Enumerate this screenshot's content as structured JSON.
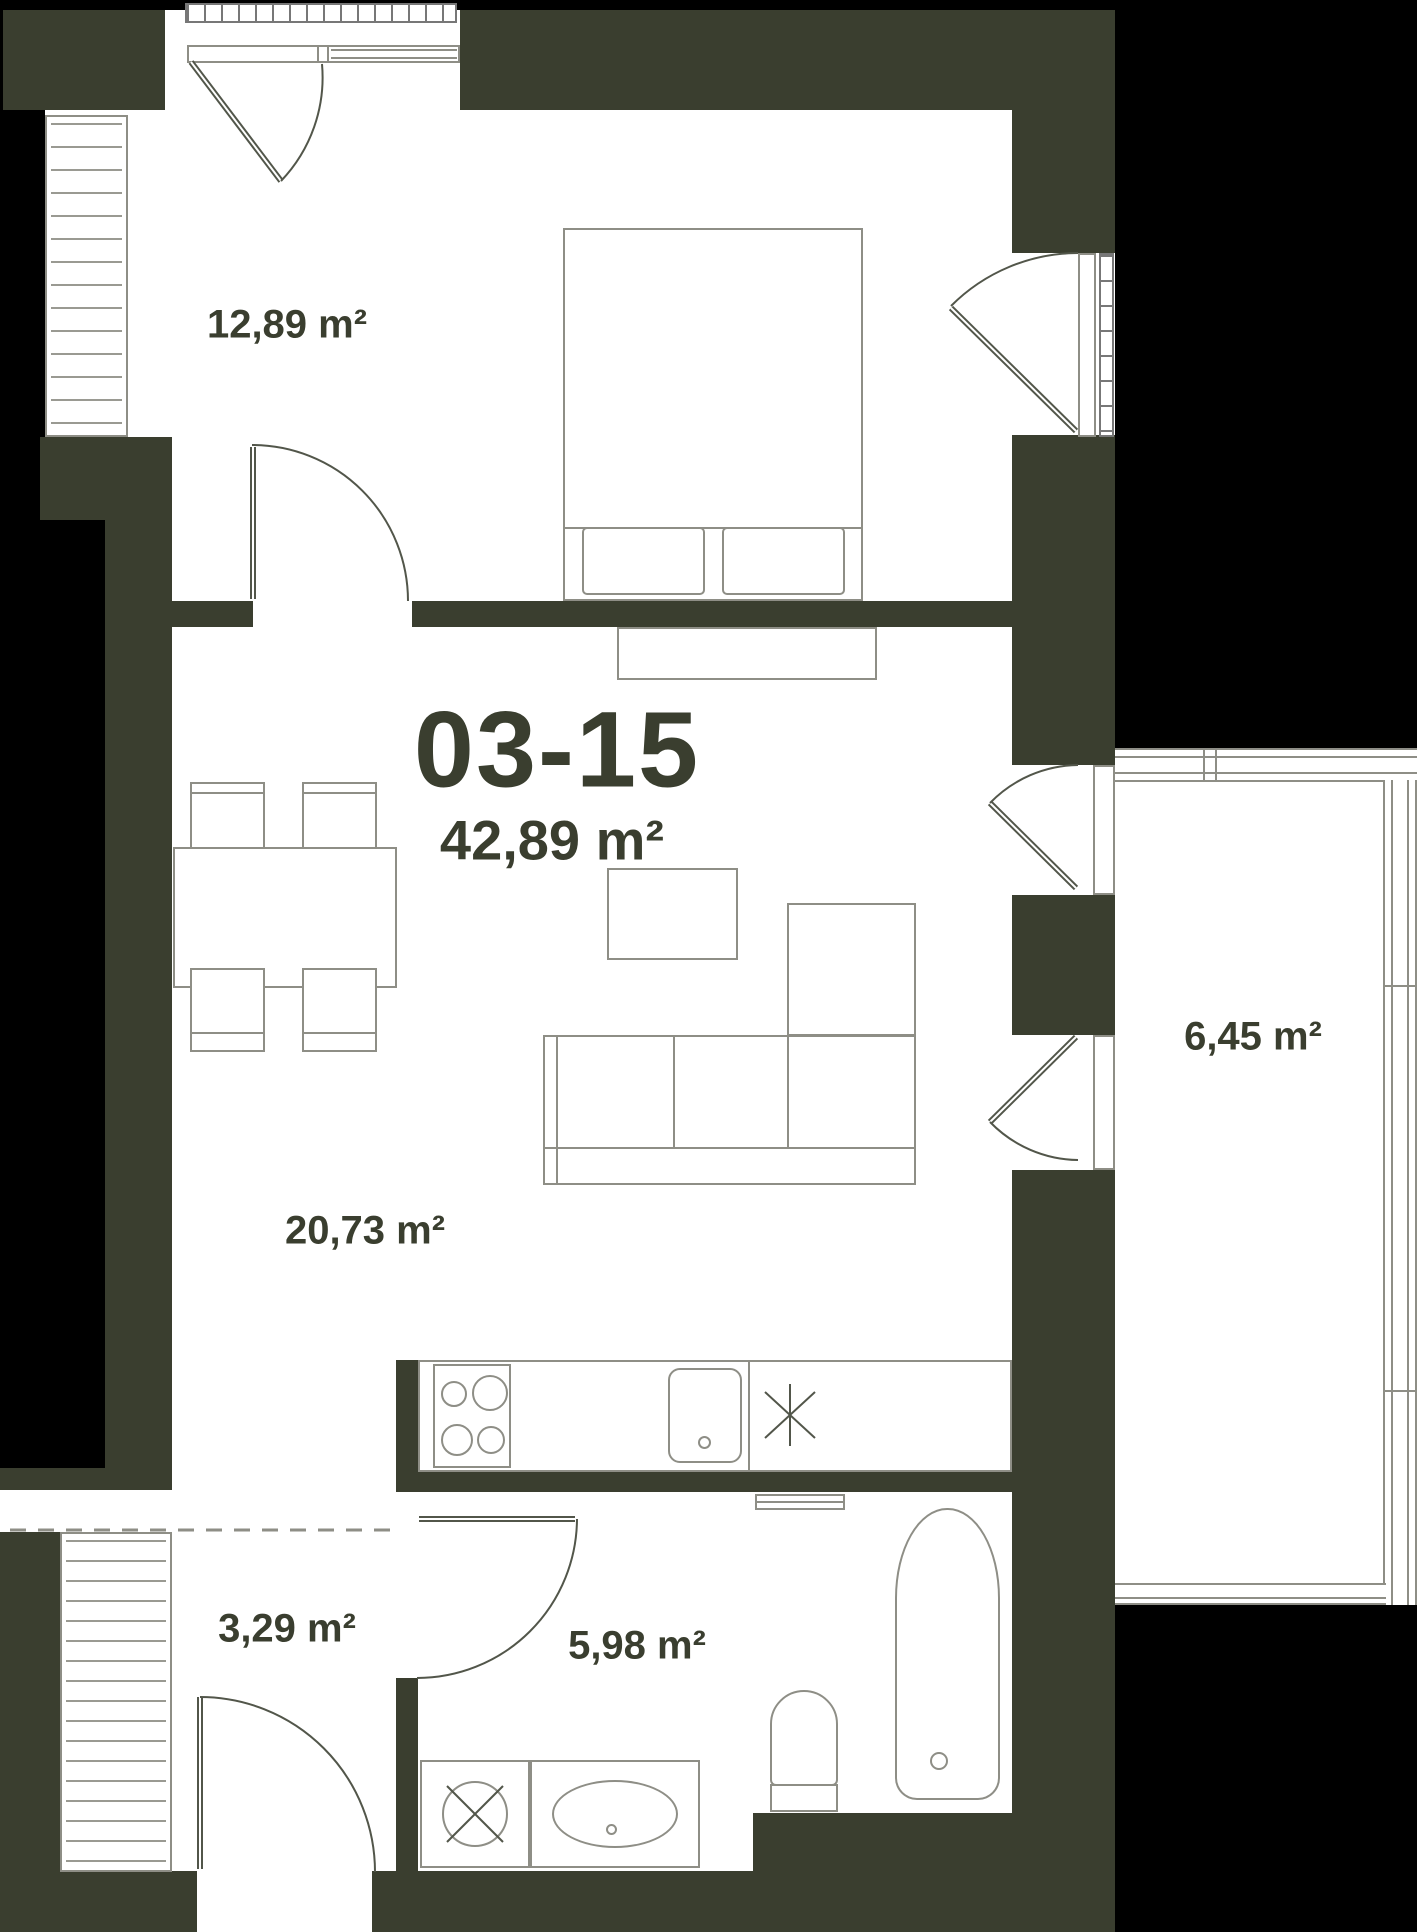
{
  "floorplan": {
    "unit_number": "03-15",
    "total_area": "42,89 m²",
    "rooms": [
      {
        "name": "bedroom",
        "area": "12,89 m²"
      },
      {
        "name": "living-room",
        "area": "20,73 m²"
      },
      {
        "name": "balcony",
        "area": "6,45 m²"
      },
      {
        "name": "hallway",
        "area": "3,29 m²"
      },
      {
        "name": "bathroom",
        "area": "5,98 m²"
      }
    ],
    "colors": {
      "background": "#000000",
      "wall": "#3a3e2f",
      "floor": "#ffffff",
      "furniture_stroke": "#8e8e86",
      "door_stroke": "#52564a",
      "label_text": "#3a3e2f"
    }
  }
}
